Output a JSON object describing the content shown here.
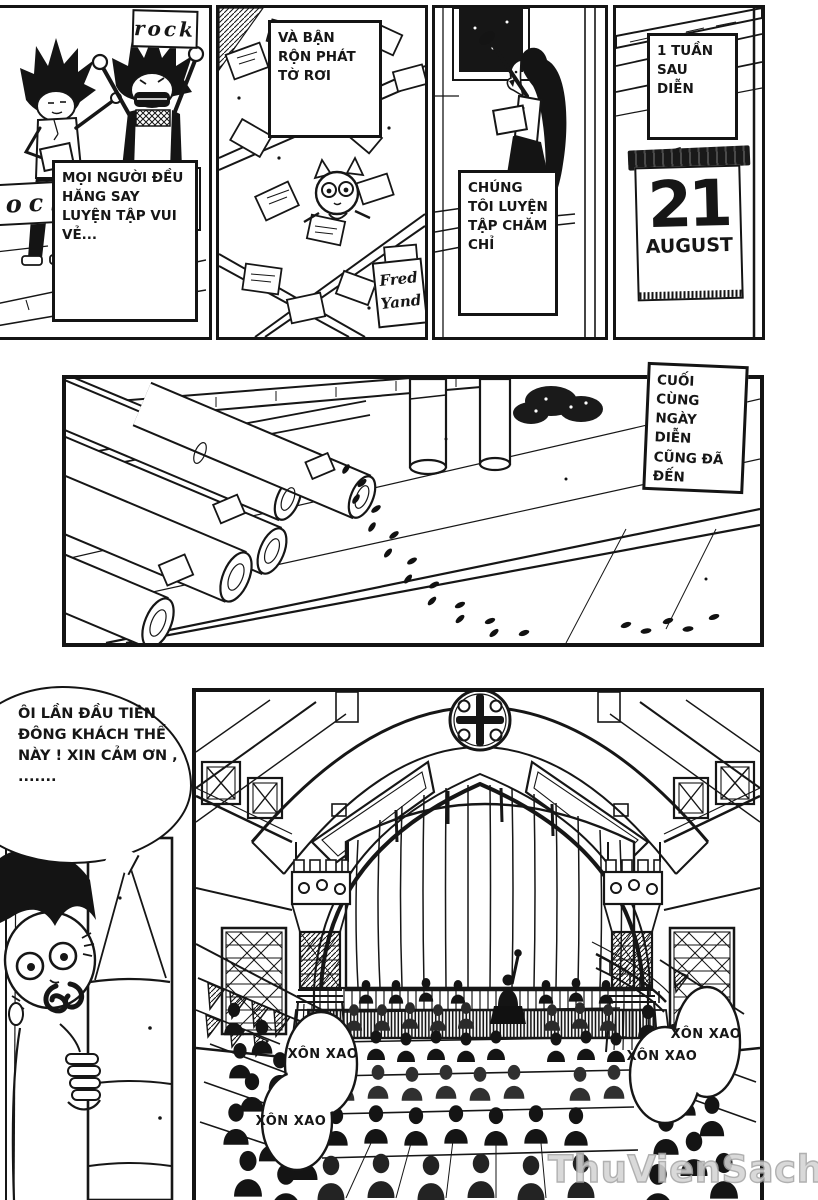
{
  "captions": {
    "practice": "MỌI NGƯỜI ĐỀU HĂNG SAY LUYỆN TẬP VUI VẺ...",
    "flyers": "VÀ BẬN RỘN PHÁT TỜ RƠI",
    "rehearse": "CHÚNG TÔI LUYỆN TẬP CHĂM CHỈ",
    "one_week": "1 TUẦN SAU DIỄN",
    "show_day": "CUỐI CÙNG NGÀY DIỄN CŨNG ĐÃ ĐẾN"
  },
  "signs": {
    "rock_top": "rock",
    "rock_left": "rock",
    "fred_line1": "Fred",
    "fred_line2": "Yand"
  },
  "calendar": {
    "day": "21",
    "month": "AUGUST"
  },
  "speech": {
    "manager": "ÔI LẦN ĐẦU TIÊN ĐÔNG KHÁCH THẾ NÀY ! XIN CẢM ƠN , .......",
    "crowd": [
      "XÔN XAO",
      "XÔN XAO",
      "XÔN XAO",
      "XÔN XAO"
    ]
  },
  "watermark": "ThuVienSach.vn",
  "colors": {
    "ink": "#161616",
    "paper": "#ffffff",
    "watermark_gray": "#bfbfbf"
  }
}
